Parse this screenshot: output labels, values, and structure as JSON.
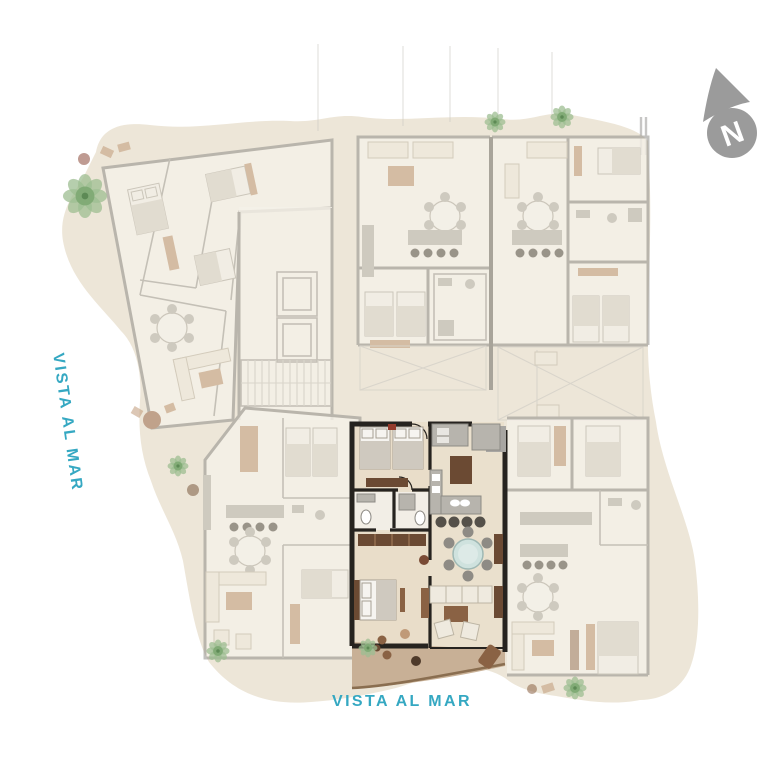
{
  "labels": {
    "sea_view_left": "VISTA AL MAR",
    "sea_view_bottom": "VISTA AL MAR",
    "compass_north": "N"
  },
  "icons": {
    "compass": "north-arrow-icon",
    "vegetation": "tree-icon"
  },
  "colors": {
    "accent_teal": "#35a8c2",
    "site_fill": "#ede6d8",
    "terrace_tan": "#c8b096",
    "terrace_edge": "#8a6e50",
    "highlight_wall": "#26231f",
    "faded_wall": "#8f8d89",
    "wood_brown": "#6b4a33",
    "table_teal": "#cfe2de",
    "tree_green": "#9dbd92",
    "compass_gray": "#9b9b9b"
  },
  "trees": [
    {
      "x": 85,
      "y": 196,
      "r": 21
    },
    {
      "x": 495,
      "y": 122,
      "r": 10
    },
    {
      "x": 562,
      "y": 117,
      "r": 11
    },
    {
      "x": 178,
      "y": 466,
      "r": 10
    },
    {
      "x": 218,
      "y": 651,
      "r": 11
    },
    {
      "x": 368,
      "y": 648,
      "r": 9
    },
    {
      "x": 575,
      "y": 688,
      "r": 11
    }
  ]
}
